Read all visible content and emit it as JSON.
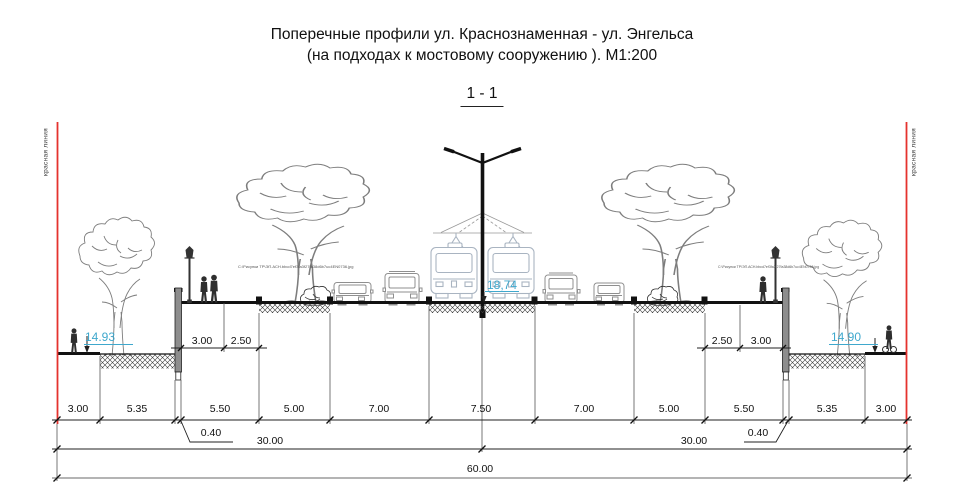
{
  "title": {
    "line1": "Поперечные профили ул. Краснознаменная - ул. Энгельса",
    "line2": "(на подходах к мостовому сооружению ).   М1:200"
  },
  "section_label": "1 - 1",
  "red_lines": {
    "left_label": "красная линия",
    "right_label": "красная линия",
    "color": "#e5322e"
  },
  "elevations": {
    "left": "14.93",
    "center": "18,74",
    "right": "14.90",
    "text_color": "#3fa8cd"
  },
  "annotations": {
    "file_path_left": "С:\\Рисунки ТР\\ЭП.АСН.bbcd7ef3fa3f27fa38d6b7uc4EN0736.jpg",
    "file_path_right": "С:\\Рисунки ТР\\ЭП.АСН.bbcd7ef3fa3f27fa38d6b7uc4EN0736.jpg"
  },
  "dimensions": {
    "row1": [
      "3.00",
      "5.35",
      "5.50",
      "5.00",
      "7.00",
      "7.50",
      "7.00",
      "5.00",
      "5.50",
      "5.35",
      "3.00"
    ],
    "wall_left": "0.40",
    "wall_right": "0.40",
    "row2_left": "30.00",
    "row2_right": "30.00",
    "total": "60.00",
    "sub_left": [
      "3.00",
      "2.50"
    ],
    "sub_right": [
      "2.50",
      "3.00"
    ]
  },
  "colors": {
    "linework": "#1a1a1a",
    "tram_outline": "#a9b4c1",
    "car_outline": "#8f8f8f",
    "soil_hatch": "#3c3c3c"
  }
}
